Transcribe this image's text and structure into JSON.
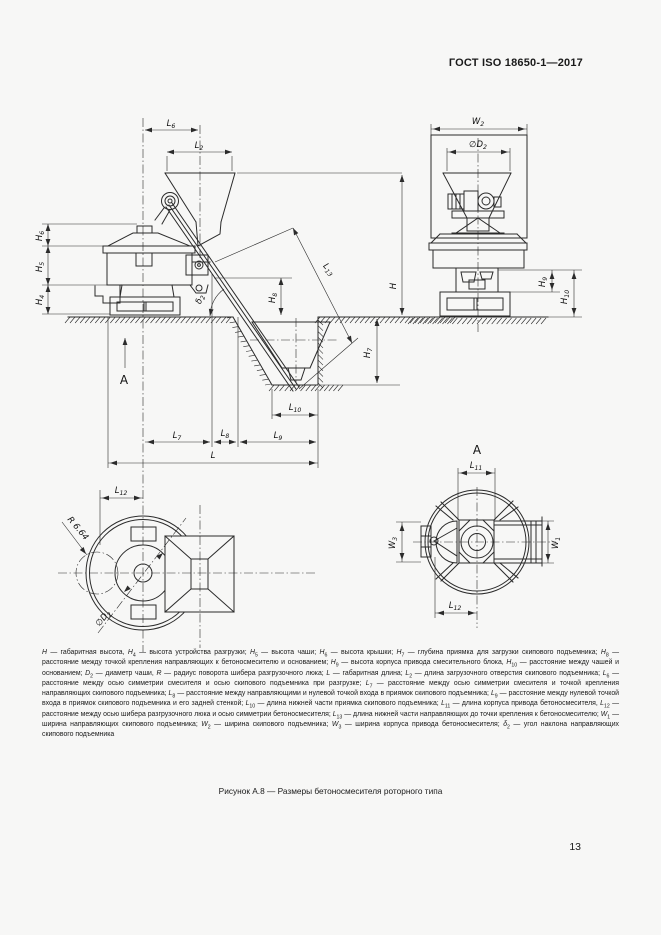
{
  "page": {
    "header": "ГОСТ ISO 18650-1—2017",
    "caption": "Рисунок А.8 — Размеры бетоносмесителя роторного типа",
    "page_number": "13"
  },
  "colors": {
    "background": "#f7f7f6",
    "line": "#2b2b2b",
    "text": "#1a1a1a"
  },
  "dims": {
    "H": {
      "base": "H",
      "sub": ""
    },
    "H4": {
      "base": "H",
      "sub": "4"
    },
    "H5": {
      "base": "H",
      "sub": "5"
    },
    "H6": {
      "base": "H",
      "sub": "6"
    },
    "H7": {
      "base": "H",
      "sub": "7"
    },
    "H8": {
      "base": "H",
      "sub": "8"
    },
    "H9": {
      "base": "H",
      "sub": "9"
    },
    "H10": {
      "base": "H",
      "sub": "10"
    },
    "L": {
      "base": "L",
      "sub": ""
    },
    "L2": {
      "base": "L",
      "sub": "2"
    },
    "L6": {
      "base": "L",
      "sub": "6"
    },
    "L7": {
      "base": "L",
      "sub": "7"
    },
    "L8": {
      "base": "L",
      "sub": "8"
    },
    "L9": {
      "base": "L",
      "sub": "9"
    },
    "L10": {
      "base": "L",
      "sub": "10"
    },
    "L11": {
      "base": "L",
      "sub": "11"
    },
    "L12": {
      "base": "L",
      "sub": "12"
    },
    "L13": {
      "base": "L",
      "sub": "13"
    },
    "W1": {
      "base": "W",
      "sub": "1"
    },
    "W2": {
      "base": "W",
      "sub": "2"
    },
    "W3": {
      "base": "W",
      "sub": "3"
    },
    "D2": {
      "base": "∅D",
      "sub": "2"
    },
    "R": {
      "base": "R 6.64",
      "sub": ""
    },
    "d2": {
      "base": "δ",
      "sub": "2"
    },
    "A": {
      "base": "А",
      "sub": ""
    }
  },
  "legend": {
    "items": [
      {
        "base": "H",
        "sub": "",
        "def": "габаритная высота",
        "sep": ","
      },
      {
        "base": "H",
        "sub": "4",
        "def": "высота устройства разгрузки",
        "sep": ";"
      },
      {
        "base": "H",
        "sub": "5",
        "def": "высота чаши",
        "sep": ";"
      },
      {
        "base": "H",
        "sub": "6",
        "def": "высота крышки",
        "sep": ";"
      },
      {
        "base": "H",
        "sub": "7",
        "def": "глубина приямка для загрузки скипового подъемника",
        "sep": ";"
      },
      {
        "base": "H",
        "sub": "8",
        "def": "расстояние между точкой крепления направляющих к бетоносмесителю и основанием",
        "sep": ";"
      },
      {
        "base": "H",
        "sub": "9",
        "def": "высота корпуса привода смесительного блока",
        "sep": ","
      },
      {
        "base": "H",
        "sub": "10",
        "def": "расстояние между чашей и основанием",
        "sep": ";"
      },
      {
        "base": "D",
        "sub": "2",
        "def": "диаметр чаши",
        "sep": ","
      },
      {
        "base": "R",
        "sub": "",
        "def": "радиус поворота шибера разгрузочного люка",
        "sep": ";"
      },
      {
        "base": "L",
        "sub": "",
        "def": "габаритная длина",
        "sep": ";"
      },
      {
        "base": "L",
        "sub": "2",
        "def": "длина загрузочного отверстия скипового подъемника",
        "sep": ";"
      },
      {
        "base": "L",
        "sub": "6",
        "def": "расстояние между осью симметрии смесителя и осью скипового подъемника при разгрузке",
        "sep": ";"
      },
      {
        "base": "L",
        "sub": "7",
        "def": "расстояние между осью симметрии смесителя и точкой крепления направляющих скипового подъемника",
        "sep": ";"
      },
      {
        "base": "L",
        "sub": "8",
        "def": "расстояние между направляющими и нулевой точкой входа в приямок скипового подъемника",
        "sep": ";"
      },
      {
        "base": "L",
        "sub": "9",
        "def": "расстояние между нулевой точкой входа в приямок скипового подъемника и его задней стенкой",
        "sep": ";"
      },
      {
        "base": "L",
        "sub": "10",
        "def": "длина нижней части приямка скипового подъемника",
        "sep": ";"
      },
      {
        "base": "L",
        "sub": "11",
        "def": "длина корпуса привода бетоносмесителя",
        "sep": ","
      },
      {
        "base": "L",
        "sub": "12",
        "def": "расстояние между осью шибера разгрузочного люка и осью симметрии бетоносмесителя",
        "sep": ";"
      },
      {
        "base": "L",
        "sub": "13",
        "def": "длина нижней части направляющих до точки крепления к бетоносмесителю",
        "sep": ";"
      },
      {
        "base": "W",
        "sub": "1",
        "def": "ширина направляющих скипового подъемника",
        "sep": ";"
      },
      {
        "base": "W",
        "sub": "2",
        "def": "ширина скипового подъемника",
        "sep": ";"
      },
      {
        "base": "W",
        "sub": "3",
        "def": "ширина корпуса привода бетоносмесителя",
        "sep": ";"
      },
      {
        "base": "δ",
        "sub": "2",
        "def": "угол наклона направляющих скипового подъемника",
        "sep": ""
      }
    ]
  }
}
